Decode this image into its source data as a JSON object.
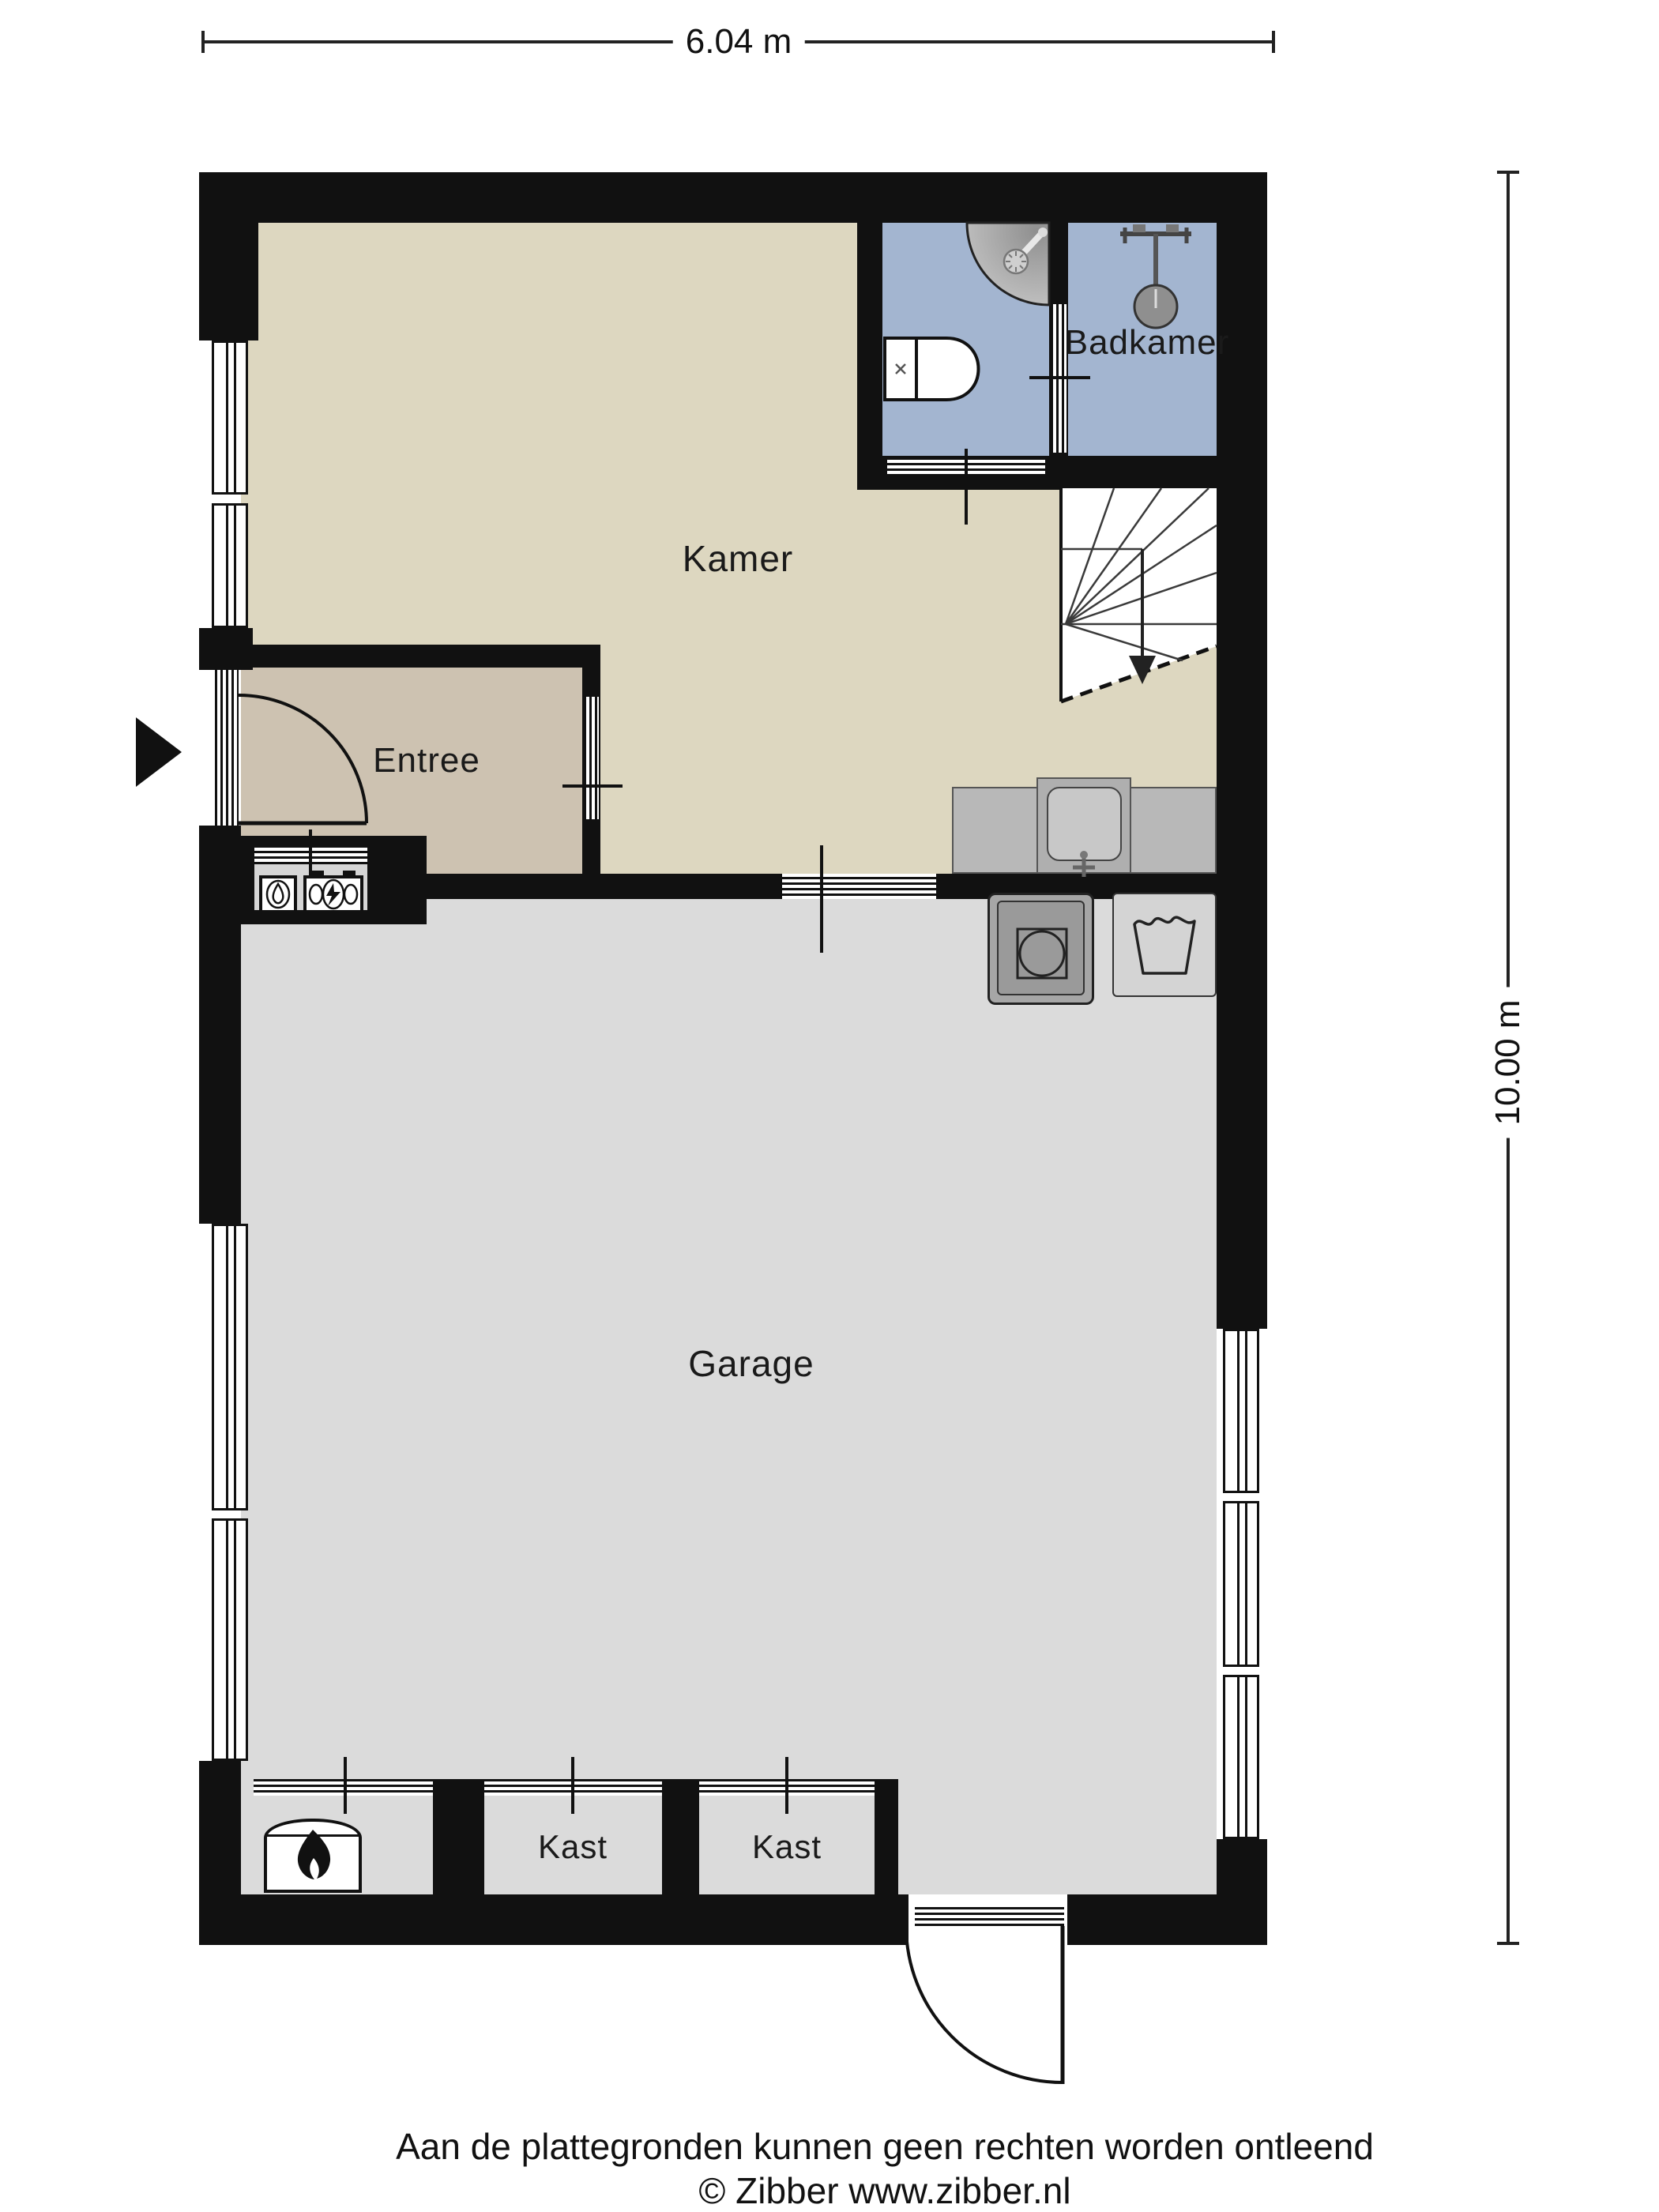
{
  "dimensions": {
    "width": "6.04 m",
    "height": "10.00 m"
  },
  "rooms": {
    "kamer": "Kamer",
    "badkamer": "Badkamer",
    "entree": "Entree",
    "garage": "Garage",
    "kast1": "Kast",
    "kast2": "Kast"
  },
  "footer": {
    "disclaimer": "Aan de plattegronden kunnen geen rechten worden ontleend",
    "credit": "© Zibber www.zibber.nl"
  },
  "fixtures": [
    "corner-shower",
    "toilet",
    "washbasin",
    "kitchen-sink",
    "washing-machine",
    "laundry-tub",
    "boiler-flame",
    "gas-meter",
    "electricity-meter",
    "stairs-down",
    "entrance-arrow",
    "front-door",
    "back-door"
  ],
  "colors": {
    "wall": "#111111",
    "kamer_floor": "#ddd7c0",
    "entree_floor": "#cdc2b1",
    "garage_floor": "#dbdbdb",
    "bathroom_floor": "#a3b5d0",
    "counter": "#b8b8b8",
    "background": "#ffffff"
  }
}
